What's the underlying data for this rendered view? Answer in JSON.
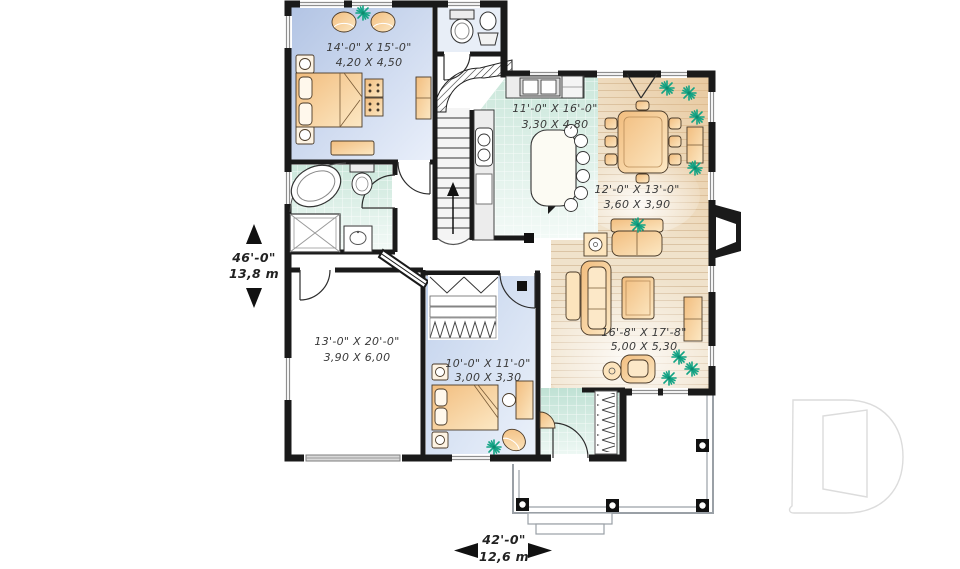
{
  "rooms": {
    "master_bedroom": {
      "imperial": "14'-0\" X 15'-0\"",
      "metric": "4,20 X 4,50"
    },
    "kitchen": {
      "imperial": "11'-0\" X 16'-0\"",
      "metric": "3,30 X 4,80"
    },
    "dining_room": {
      "imperial": "12'-0\" X 13'-0\"",
      "metric": "3,60 X 3,90"
    },
    "living_room": {
      "imperial": "16'-8\" X 17'-8\"",
      "metric": "5,00 X 5,30"
    },
    "garage": {
      "imperial": "13'-0\" X 20'-0\"",
      "metric": "3,90 X 6,00"
    },
    "bedroom_2": {
      "imperial": "10'-0\" X 11'-0\"",
      "metric": "3,00 X 3,30"
    }
  },
  "overall_dimensions": {
    "depth": {
      "imperial": "46'-0\"",
      "metric": "13,8 m"
    },
    "width": {
      "imperial": "42'-0\"",
      "metric": "12,6 m"
    }
  },
  "watermark": {
    "icon": "d-logo"
  },
  "icons": {
    "plant": "plant-icon",
    "arrow_up": "arrow-up-icon",
    "arrow_down": "arrow-down-icon",
    "arrow_left": "arrow-left-icon",
    "arrow_right": "arrow-right-icon",
    "stairs_up": "stairs-up-arrow-icon"
  },
  "colors": {
    "wall": "#1a1a1a",
    "master_bedroom_floor": "#bcccE8",
    "bedroom2_floor": "#c9d7ee",
    "tile_floor": "#d4eae0",
    "entry_floor": "#c4e3d7",
    "wood_floor": "#f0e2cb",
    "wood_accent": "#e6c392",
    "furniture": "#f5c98e",
    "plant": "#13a384",
    "porch_line": "#9aa0a6",
    "logo_line": "#dcdcdc",
    "text": "#333333"
  }
}
